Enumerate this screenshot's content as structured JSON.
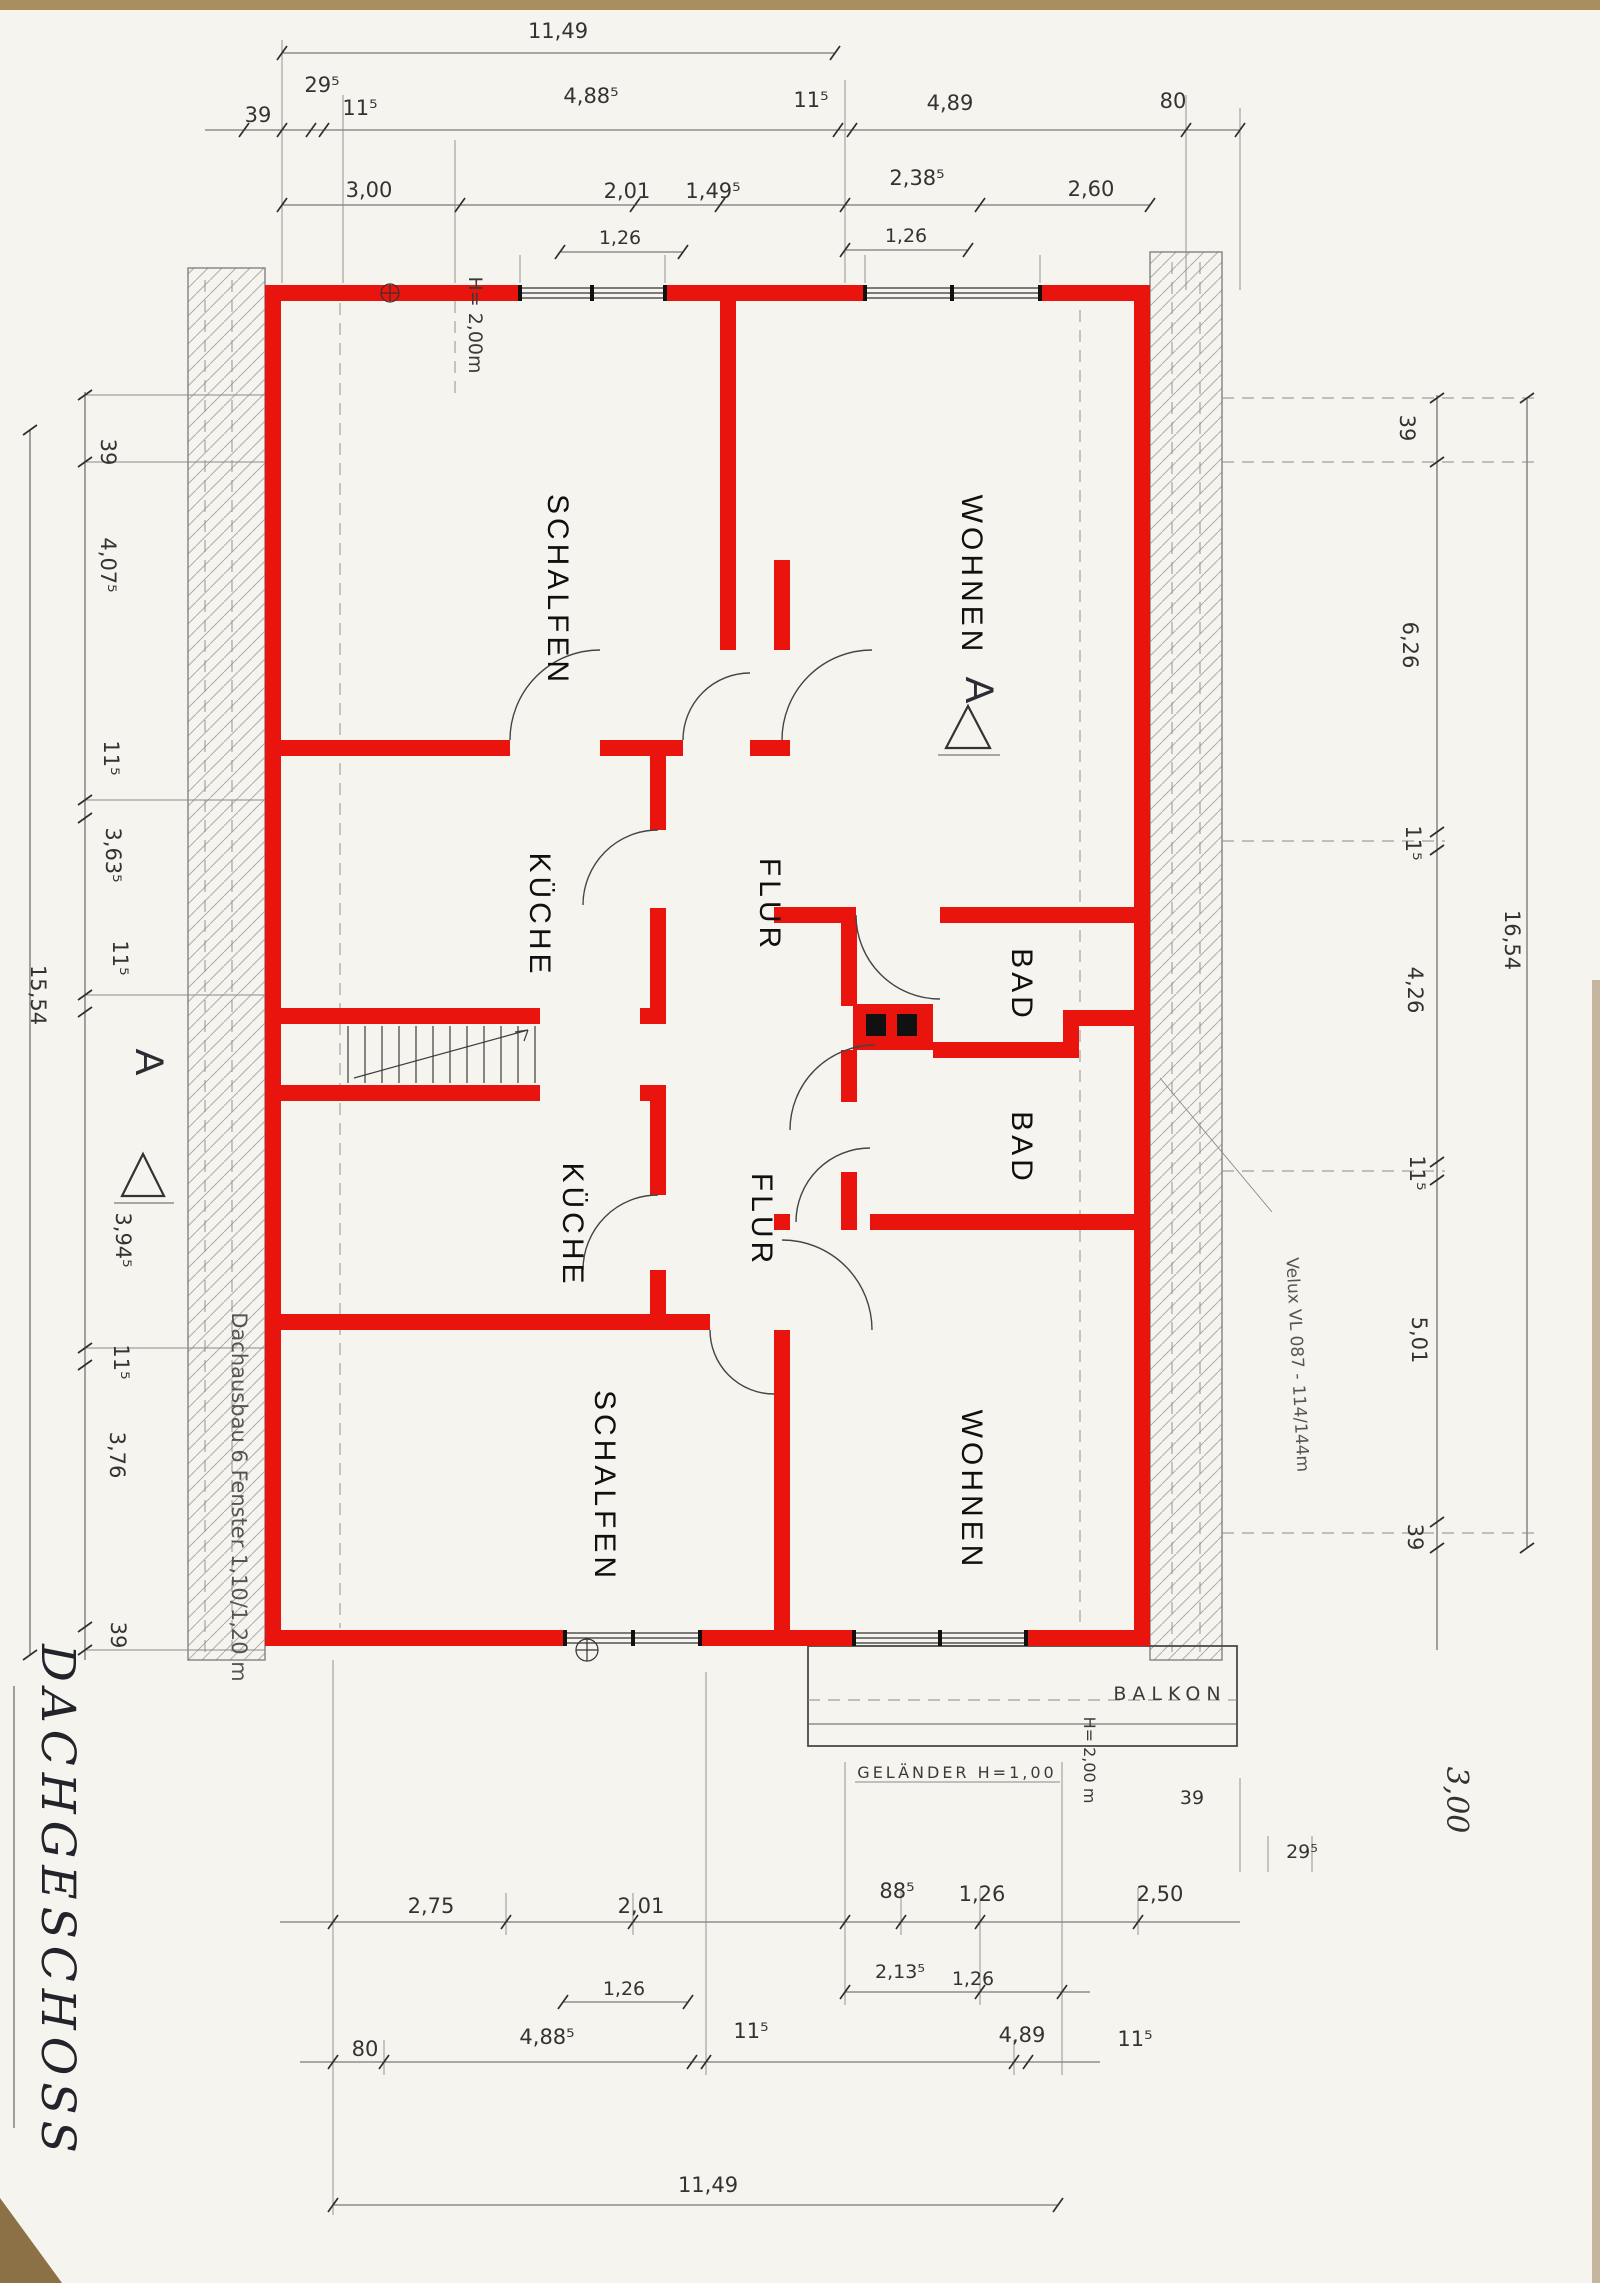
{
  "title": "DACHGESCHOSS",
  "rooms": {
    "schlafen_top": "SCHALFEN",
    "wohnen_top": "WOHNEN",
    "kueche_top": "KÜCHE",
    "flur_top": "FLUR",
    "bad_top": "BAD",
    "bad_bottom": "BAD",
    "kueche_bottom": "KÜCHE",
    "flur_bottom": "FLUR",
    "schlafen_bottom": "SCHALFEN",
    "wohnen_bottom": "WOHNEN"
  },
  "annotations": {
    "floor_title": "DACHGESCHOSS",
    "height_note_top": "H= 2,00m",
    "height_note_bottom": "H= 2,00 m",
    "balcony": "BALKON",
    "railing": "GELÄNDER H=1,00",
    "roof_note": "Dachausbau  6 Fenster  1,10/1,20 m",
    "velux_note": "Velux VL 087 - 114/144m",
    "section_marker_left": "A",
    "section_marker_right": "A"
  },
  "dims": {
    "top": {
      "overall": "11,49",
      "row2": [
        "39",
        "29⁵",
        "11⁵",
        "4,88⁵",
        "11⁵",
        "4,89",
        "80"
      ],
      "row3": [
        "3,00",
        "2,01",
        "1,49⁵",
        "2,38⁵",
        "2,60"
      ],
      "row4": [
        "1,26",
        "1,26"
      ]
    },
    "bottom": {
      "rowA": [
        "2,75",
        "2,01",
        "88⁵",
        "1,26",
        "2,50"
      ],
      "rowB": [
        "1,26",
        "2,13⁵",
        "1,26"
      ],
      "rowC": [
        "80",
        "4,88⁵",
        "11⁵",
        "4,89",
        "11⁵"
      ],
      "corner": [
        "39",
        "29⁵"
      ],
      "overall": "11,49",
      "script": "3,00"
    },
    "left": {
      "segments": [
        "39",
        "4,07⁵",
        "11⁵",
        "3,63⁵",
        "11⁵",
        "3,94⁵",
        "11⁵",
        "3,76",
        "39"
      ],
      "overall": "15,54"
    },
    "right": {
      "segments": [
        "39",
        "6,26",
        "11⁵",
        "4,26",
        "11⁵",
        "5,01",
        "39"
      ],
      "overall": "16,54"
    }
  },
  "colors": {
    "wall_red": "#e8140d",
    "ink": "#333333",
    "paper": "#f6f4ee",
    "scan_edge": "#a98e5f"
  }
}
